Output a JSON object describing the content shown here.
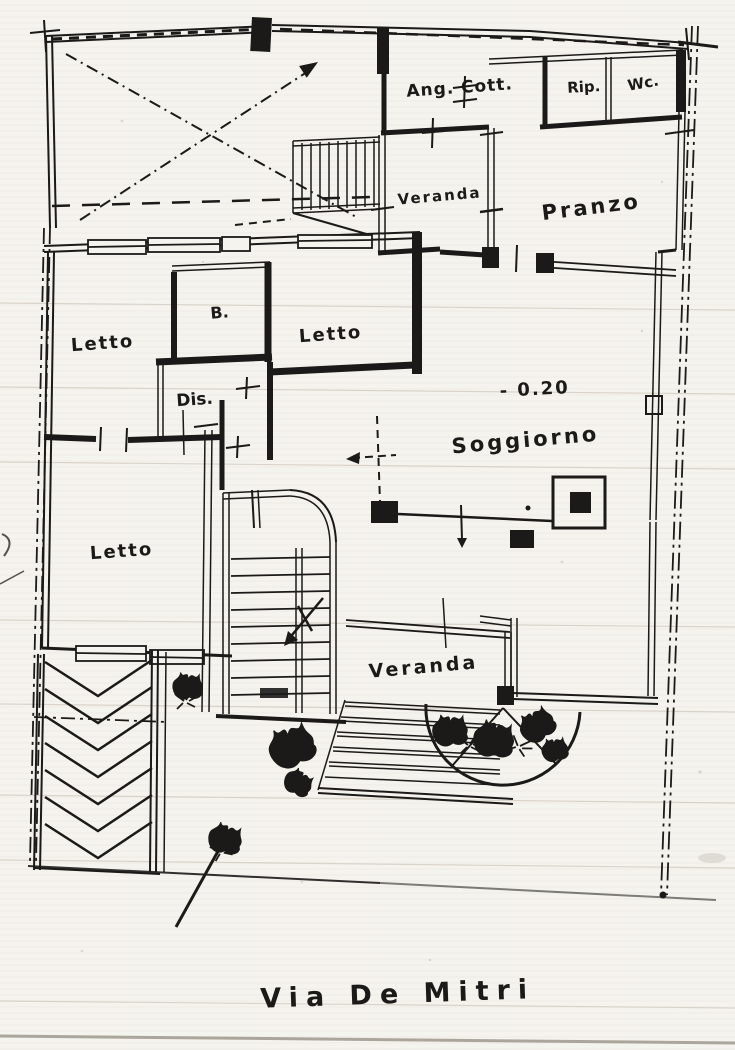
{
  "plan": {
    "rooms": [
      {
        "id": "ang-cott",
        "label": "Ang. Cott."
      },
      {
        "id": "rip",
        "label": "Rip."
      },
      {
        "id": "wc",
        "label": "Wc."
      },
      {
        "id": "veranda-top",
        "label": "Veranda"
      },
      {
        "id": "pranzo",
        "label": "Pranzo"
      },
      {
        "id": "letto-nw",
        "label": "Letto"
      },
      {
        "id": "bagno",
        "label": "B."
      },
      {
        "id": "letto-n",
        "label": "Letto"
      },
      {
        "id": "dis",
        "label": "Dis."
      },
      {
        "id": "soggiorno",
        "label": "Soggiorno"
      },
      {
        "id": "letto-sw",
        "label": "Letto"
      },
      {
        "id": "veranda-bottom",
        "label": "Veranda"
      }
    ],
    "annotations": {
      "level": "- 0.20",
      "street": "Via De Mitri"
    }
  },
  "colors": {
    "ink": "#1b1a18",
    "paper": "#f5f3ee",
    "faint": "#d8d4ca"
  }
}
